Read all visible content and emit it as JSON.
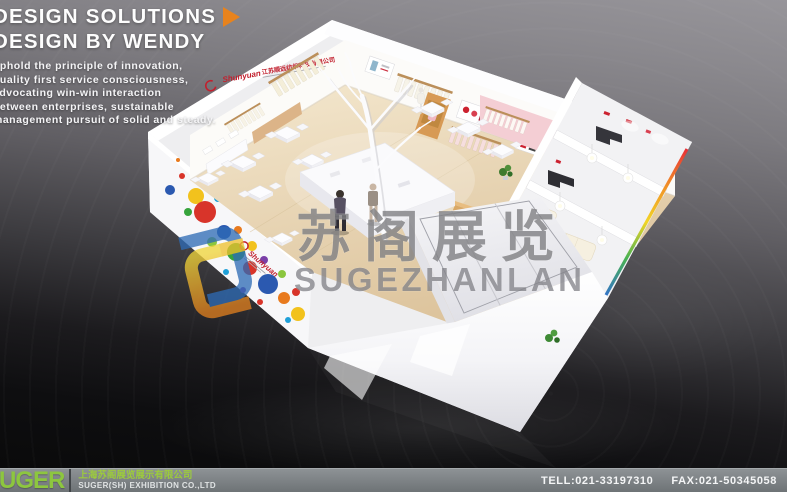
{
  "header": {
    "title_line1": "DESIGN SOLUTIONS",
    "title_line2": "DESIGN BY WENDY",
    "tagline": [
      "uphold the principle of innovation,",
      "quality first service consciousness,",
      "advocating win-win interaction",
      "between enterprises, sustainable",
      "management pursuit of solid and steady."
    ],
    "arrow_color": "#e8831d"
  },
  "watermark": {
    "cn": "苏阁展览",
    "en": "SUGEZHANLAN",
    "gray": "#7e7e82",
    "logo_blue": "#2e6cb6",
    "logo_gold": "#e8b322",
    "logo_orange": "#e07f1f"
  },
  "booth": {
    "sign_brand": "Shunyuan",
    "sign_company_cn": "江苏顺远纺织科技有限公司",
    "side_brand": "Shunyuan",
    "accent_red": "#c2202e",
    "splatter_colors": [
      "#d8342a",
      "#2b59b0",
      "#f2c21d",
      "#37a43c",
      "#e87a1e",
      "#7a3fa8",
      "#1fa0d8",
      "#8bc63f"
    ],
    "rainbow_edge": [
      "#e8262c",
      "#f08a1d",
      "#f2d41d",
      "#3fae4a",
      "#2b6fc4"
    ]
  },
  "footer": {
    "logo_text": "SUGER",
    "company_cn": "上海苏阁展览展示有限公司",
    "company_en": "SUGER(SH) EXHIBITION CO.,LTD",
    "tel": "TELL:021-33197310",
    "fax": "FAX:021-50345058",
    "accent_green": "#8dc63f"
  }
}
